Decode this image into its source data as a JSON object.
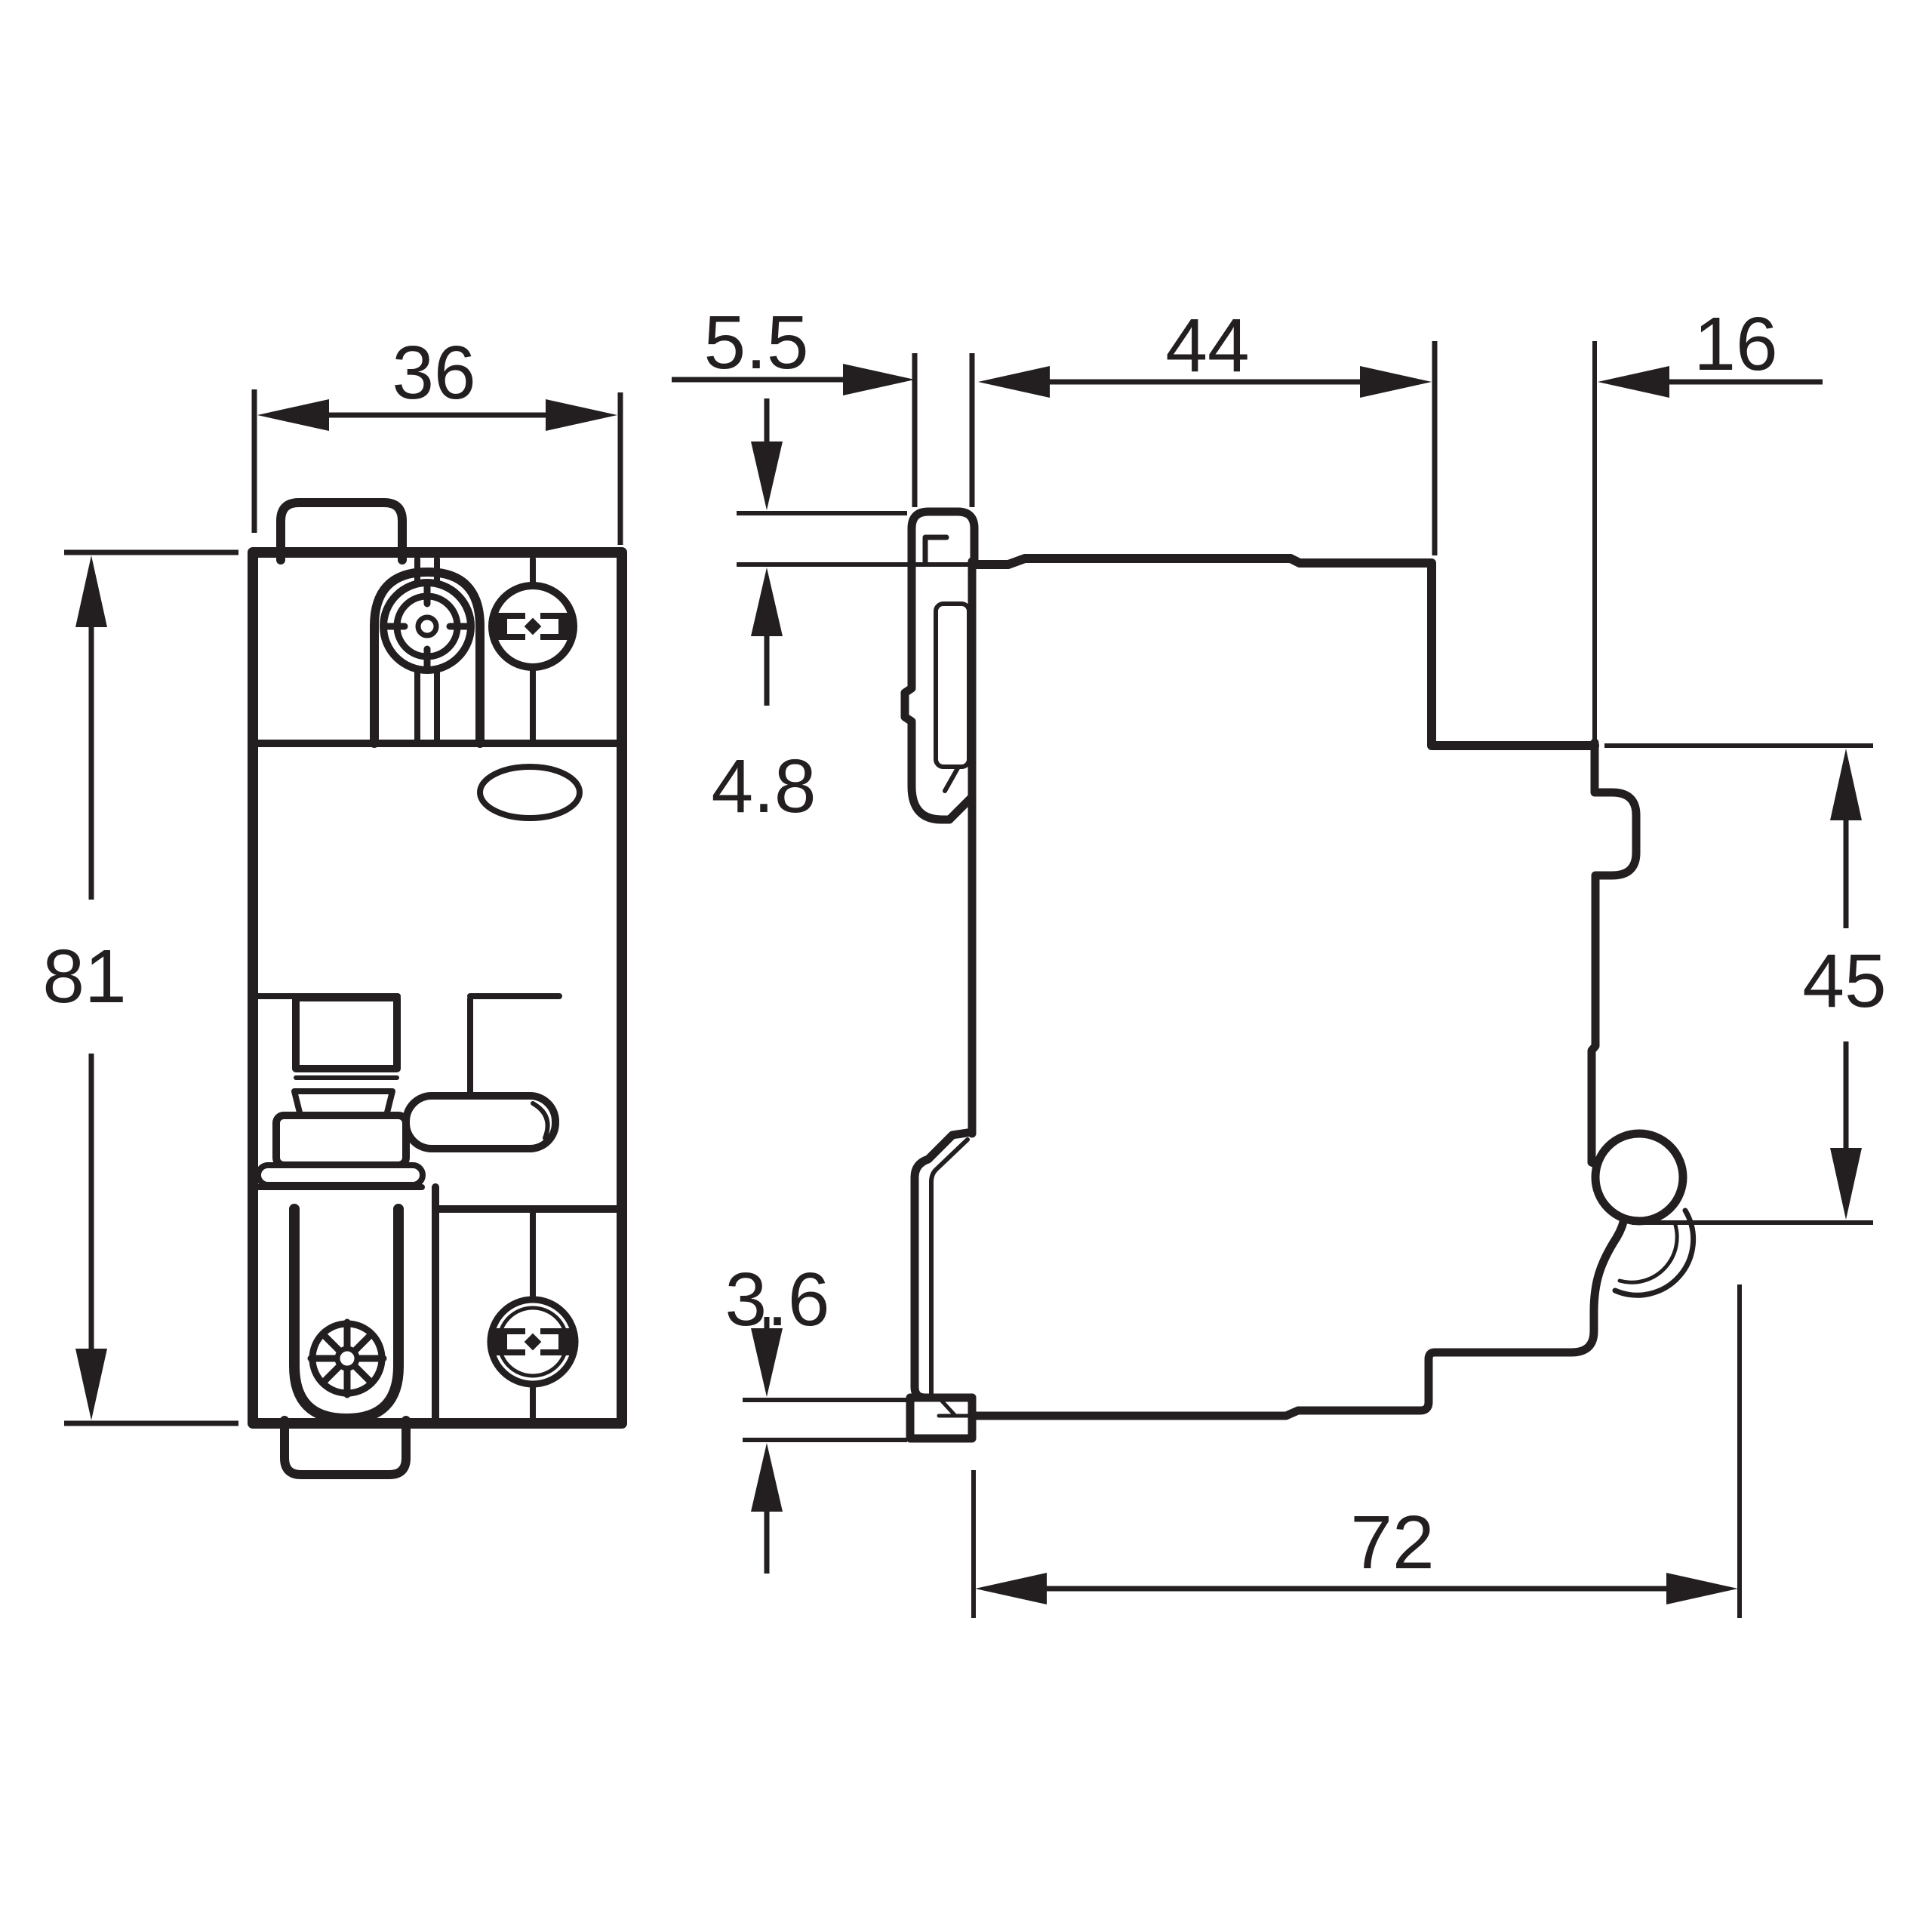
{
  "colors": {
    "line": "#231f20",
    "background": "#ffffff"
  },
  "dimensions": {
    "front_width": {
      "label": "36"
    },
    "front_height": {
      "label": "81"
    },
    "clip_lip": {
      "label": "5.5"
    },
    "body_depth": {
      "label": "44"
    },
    "front_depth": {
      "label": "16"
    },
    "clip_tab_height": {
      "label": "4.8"
    },
    "panel_height": {
      "label": "45"
    },
    "latch_travel": {
      "label": "3.6"
    },
    "total_depth": {
      "label": "72"
    }
  }
}
